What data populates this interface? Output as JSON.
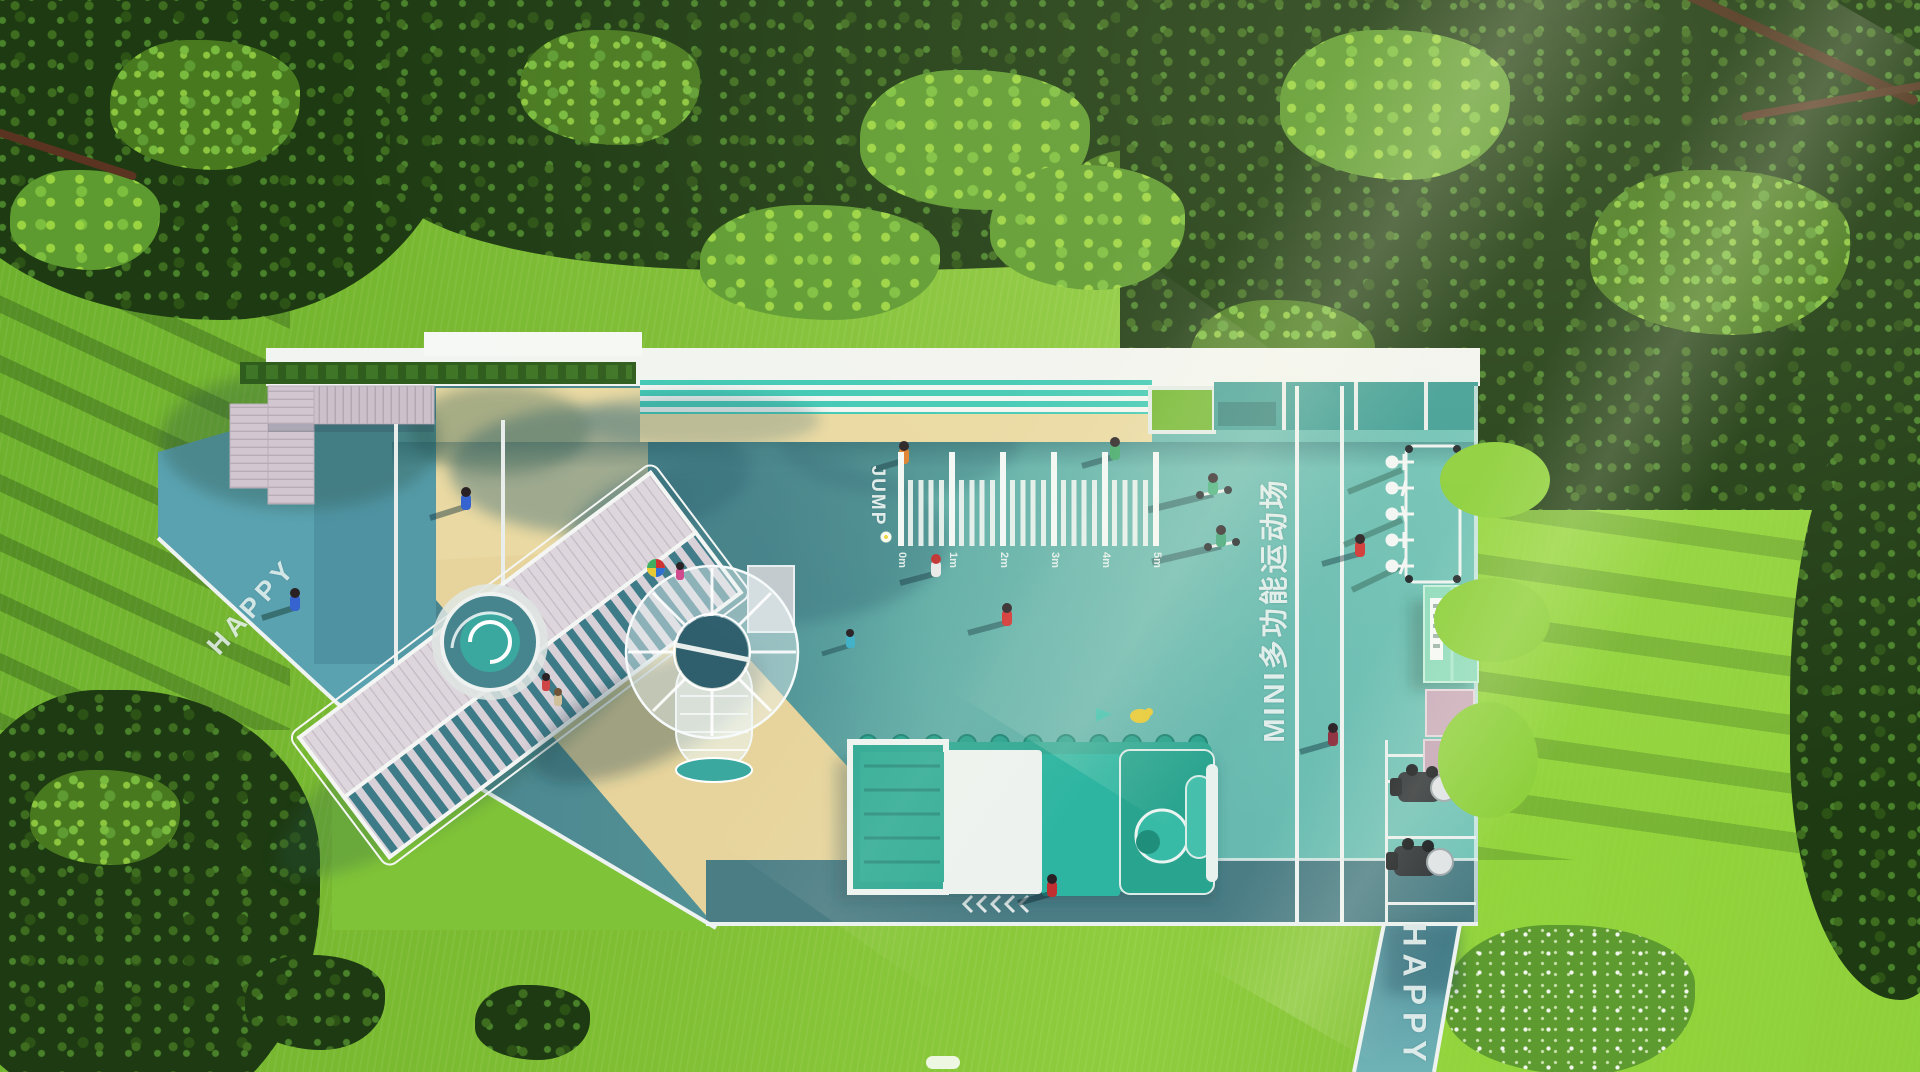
{
  "scene": {
    "type": "aerial-playground-render",
    "labels": {
      "happy_path_left": "HAPPY",
      "happy_path_bottom": "HAPPY",
      "jump": "JUMP",
      "sports_lane": "MINI多功能运动场"
    },
    "jump_ruler": {
      "ticks": [
        "0m",
        "1m",
        "2m",
        "3m",
        "4m",
        "5m"
      ]
    },
    "palette": {
      "court_shadow_teal": "#4a828c",
      "court_light_teal": "#6cbfb4",
      "path_teal": "#5aa2b0",
      "road_teal": "#4b7d85",
      "sand": "#ead9a2",
      "deck_wood": "#cabfc9",
      "stripe_teal": "#3fc9b5",
      "train_teal": "#2fa893",
      "kiosk_mint": "#8edbbc",
      "grass_bright": "#8ccf3a",
      "forest_dark": "#1d3a12",
      "marking_white": "#eef3f1"
    }
  }
}
